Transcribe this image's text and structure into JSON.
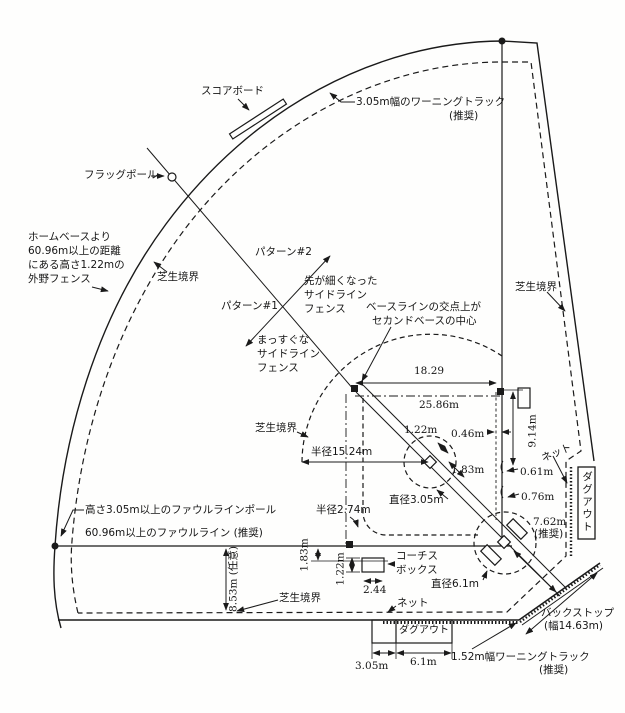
{
  "colors": {
    "ink": "#1a1a1a",
    "paper": "#fefefd"
  },
  "labels": {
    "scoreboard": "スコアボード",
    "warning_track_top": "3.05m幅のワーニングトラック",
    "warning_track_top_note": "(推奨)",
    "flag_pole": "フラッグポール",
    "outfield_note_l1": "ホームベースより",
    "outfield_note_l2": "60.96m以上の距離",
    "outfield_note_l3": "にある高さ1.22mの",
    "outfield_note_l4": "外野フェンス",
    "grass": "芝生境界",
    "pattern2": "パターン#2",
    "pattern1": "パターン#1",
    "tapered_l1": "先が細くなった",
    "tapered_l2": "サイドライン",
    "tapered_l3": "フェンス",
    "straight_l1": "まっすぐな",
    "straight_l2": "サイドライン",
    "straight_l3": "フェンス",
    "second_center_l1": "ベースラインの交点上が",
    "second_center_l2": "セカンドベースの中心",
    "net": "ネット",
    "dugout": "ダグアウト",
    "coach_l1": "コーチス",
    "coach_l2": "ボックス",
    "backstop": "バックストップ",
    "backstop_width": "(幅14.63m)",
    "warning_track_bottom": "1.52m幅ワーニングトラック",
    "warning_track_bottom_note": "(推奨)",
    "pole_note": "高さ3.05m以上のファウルラインポール",
    "foul_line_note": "60.96m以上のファウルライン (推奨)"
  },
  "dimensions": {
    "d18_29": "18.29",
    "d25_86": "25.86m",
    "d1_22_mound": "1.22m",
    "d1_83_mound": "1.83m",
    "d0_46": "0.46m",
    "d9_14": "9.14m",
    "d0_61": "0.61m",
    "d0_76": "0.76m",
    "dia3_05": "直径3.05m",
    "r15_24": "半径15.24m",
    "r2_74": "半径2.74m",
    "d7_62": "7.62m",
    "d7_62_note": "(推奨)",
    "dia6_1": "直径6.1m",
    "d1_83_third": "1.83m",
    "d1_22_third": "1.22m",
    "d2_44": "2.44",
    "d8_53": "8.53m (任意)",
    "d3_05_dugout": "3.05m",
    "d6_1_dugout": "6.1m"
  }
}
